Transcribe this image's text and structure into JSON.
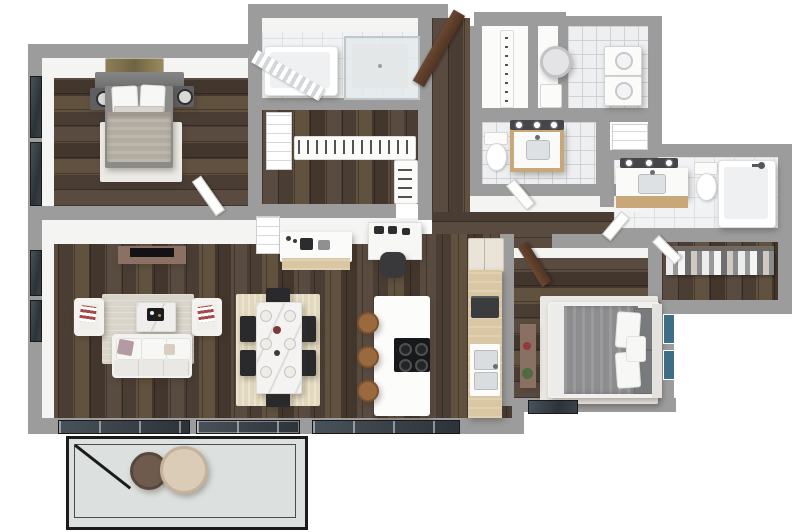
{
  "scene": {
    "title": "3D apartment floor plan rendering",
    "type": "isometric 3D floor plan, 2 bedroom / 2.5 bath with balcony",
    "background": "#ffffff",
    "visible_text": ""
  },
  "palette": {
    "wall_exterior": "#9c9c9c",
    "wall_interior": "#f4f4f3",
    "floor_wood": "#4e4138",
    "counter_wood": "#d9c7a3",
    "floor_tile": "#edeff1",
    "floor_marble": "#f1f2f4",
    "floor_concrete": "#dce0de",
    "island_white": "#fcfcfb",
    "sofa_white": "#f3f2ef",
    "rug_living": "#d9d5cb",
    "rug_dining": "#e2d8bd",
    "rug_bedroom": "#eae8e2",
    "duvet_master": "#b3aca1",
    "duvet_guest": "#8d8d90",
    "chair_black": "#2a2a2c",
    "stool_wood": "#9a6a3e",
    "door_wood": "#5d3e2b",
    "railing_black": "#1b1b1b",
    "glass_dark": "#2c3338",
    "art_gold": "#8d7f55",
    "art_blue": "#3e6e86",
    "vanity_wood": "#c8a878",
    "plant_green": "#4e6b42",
    "accent_red": "#8f3b3b"
  },
  "rooms": [
    {
      "id": "master-bedroom",
      "label": "Master Bedroom",
      "floor": "dark wood",
      "furniture": [
        "king bed with gray headboard",
        "white pillows",
        "greige duvet",
        "white area rug",
        "left nightstand with lamp",
        "right nightstand with lamp",
        "gold landscape wall art",
        "two windows on left wall",
        "white door to living room"
      ]
    },
    {
      "id": "master-bathroom",
      "label": "Master Bathroom",
      "floor": "marble tile",
      "furniture": [
        "bathtub with shower curtain",
        "glass walk-in shower"
      ]
    },
    {
      "id": "master-closet",
      "label": "Walk-in Closet",
      "floor": "dark wood",
      "furniture": [
        "shelf tower",
        "long hanging rod with hangers",
        "side hanging rod"
      ]
    },
    {
      "id": "entry-foyer",
      "label": "Entry Foyer",
      "floor": "dark wood",
      "furniture": [
        "open walnut entry door"
      ]
    },
    {
      "id": "coat-closet",
      "label": "Coat Closet",
      "floor": "white",
      "furniture": [
        "hook rail"
      ]
    },
    {
      "id": "utility-closet",
      "label": "Utility Closet",
      "floor": "white",
      "furniture": [
        "water heater"
      ]
    },
    {
      "id": "laundry-room",
      "label": "Laundry Room",
      "floor": "tile",
      "furniture": [
        "stacked washer",
        "stacked dryer"
      ]
    },
    {
      "id": "powder-room",
      "label": "Powder Room",
      "floor": "tile",
      "furniture": [
        "toilet",
        "wood vanity with sink",
        "three-bulb vanity light"
      ]
    },
    {
      "id": "hallway",
      "label": "Hallway",
      "floor": "dark wood",
      "furniture": []
    },
    {
      "id": "linen-closet",
      "label": "Linen Closet",
      "floor": "white",
      "furniture": [
        "shelf unit"
      ]
    },
    {
      "id": "bathroom-2",
      "label": "Bathroom 2",
      "floor": "marble tile",
      "furniture": [
        "wood vanity with sink",
        "three-bulb vanity light",
        "toilet",
        "bathtub with shower head"
      ]
    },
    {
      "id": "closet-2",
      "label": "Walk-in Closet 2",
      "floor": "dark wood",
      "furniture": [
        "hanging rod with clothes"
      ]
    },
    {
      "id": "bedroom-2",
      "label": "Bedroom 2",
      "floor": "dark wood",
      "furniture": [
        "queen bed with gray duvet",
        "white and gray pillows",
        "white area rug",
        "wood console with plant",
        "two blue wall art pieces",
        "window",
        "walnut door"
      ]
    },
    {
      "id": "living-room",
      "label": "Living Room",
      "floor": "dark wood",
      "furniture": [
        "media console with TV",
        "two white armchairs with red striped pillows",
        "white sofa with mauve pillow",
        "coffee table with black tray",
        "light area rug",
        "sliding balcony door",
        "two windows on left wall"
      ]
    },
    {
      "id": "dining-area",
      "label": "Dining Area",
      "floor": "dark wood",
      "furniture": [
        "marble dining table with place settings",
        "six black chairs",
        "tan woven rug"
      ]
    },
    {
      "id": "kitchen",
      "label": "Kitchen",
      "floor": "dark wood",
      "furniture": [
        "white island with black cooktop",
        "three wood bar stools",
        "light-wood perimeter counter",
        "double sink",
        "refrigerator cabinet",
        "wall oven",
        "coffee bar counter with espresso machine",
        "bar shelf unit",
        "built-in desk with black office chair"
      ]
    },
    {
      "id": "balcony",
      "label": "Balcony",
      "floor": "concrete",
      "furniture": [
        "black metal railing",
        "round dark side table",
        "round cream ottoman"
      ]
    }
  ]
}
